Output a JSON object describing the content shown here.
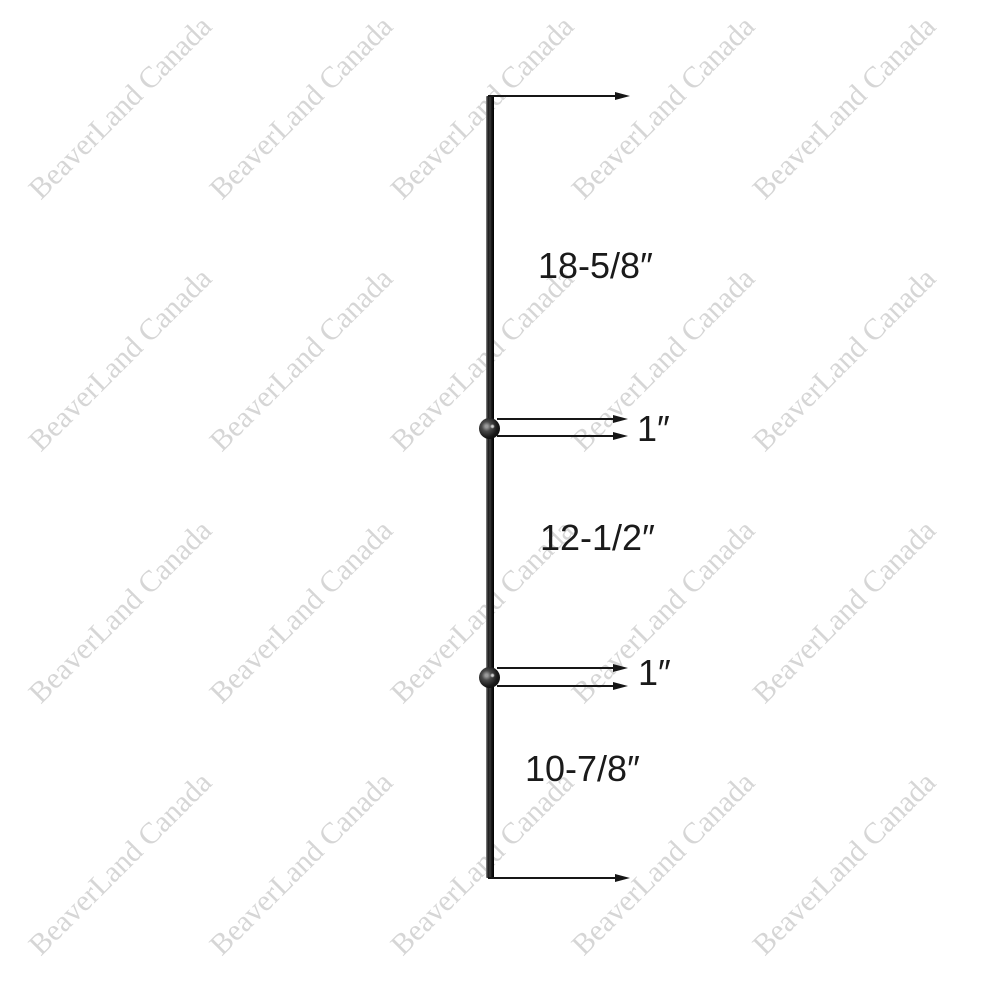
{
  "watermark": {
    "text": "BeaverLand Canada"
  },
  "dimensions": {
    "top_section": "18-5/8″",
    "upper_ball": "1″",
    "middle_section": "12-1/2″",
    "lower_ball": "1″",
    "bottom_section": "10-7/8″"
  },
  "colors": {
    "background": "#ffffff",
    "ink": "#1a1a1a",
    "watermark": "#d6d6d6"
  }
}
